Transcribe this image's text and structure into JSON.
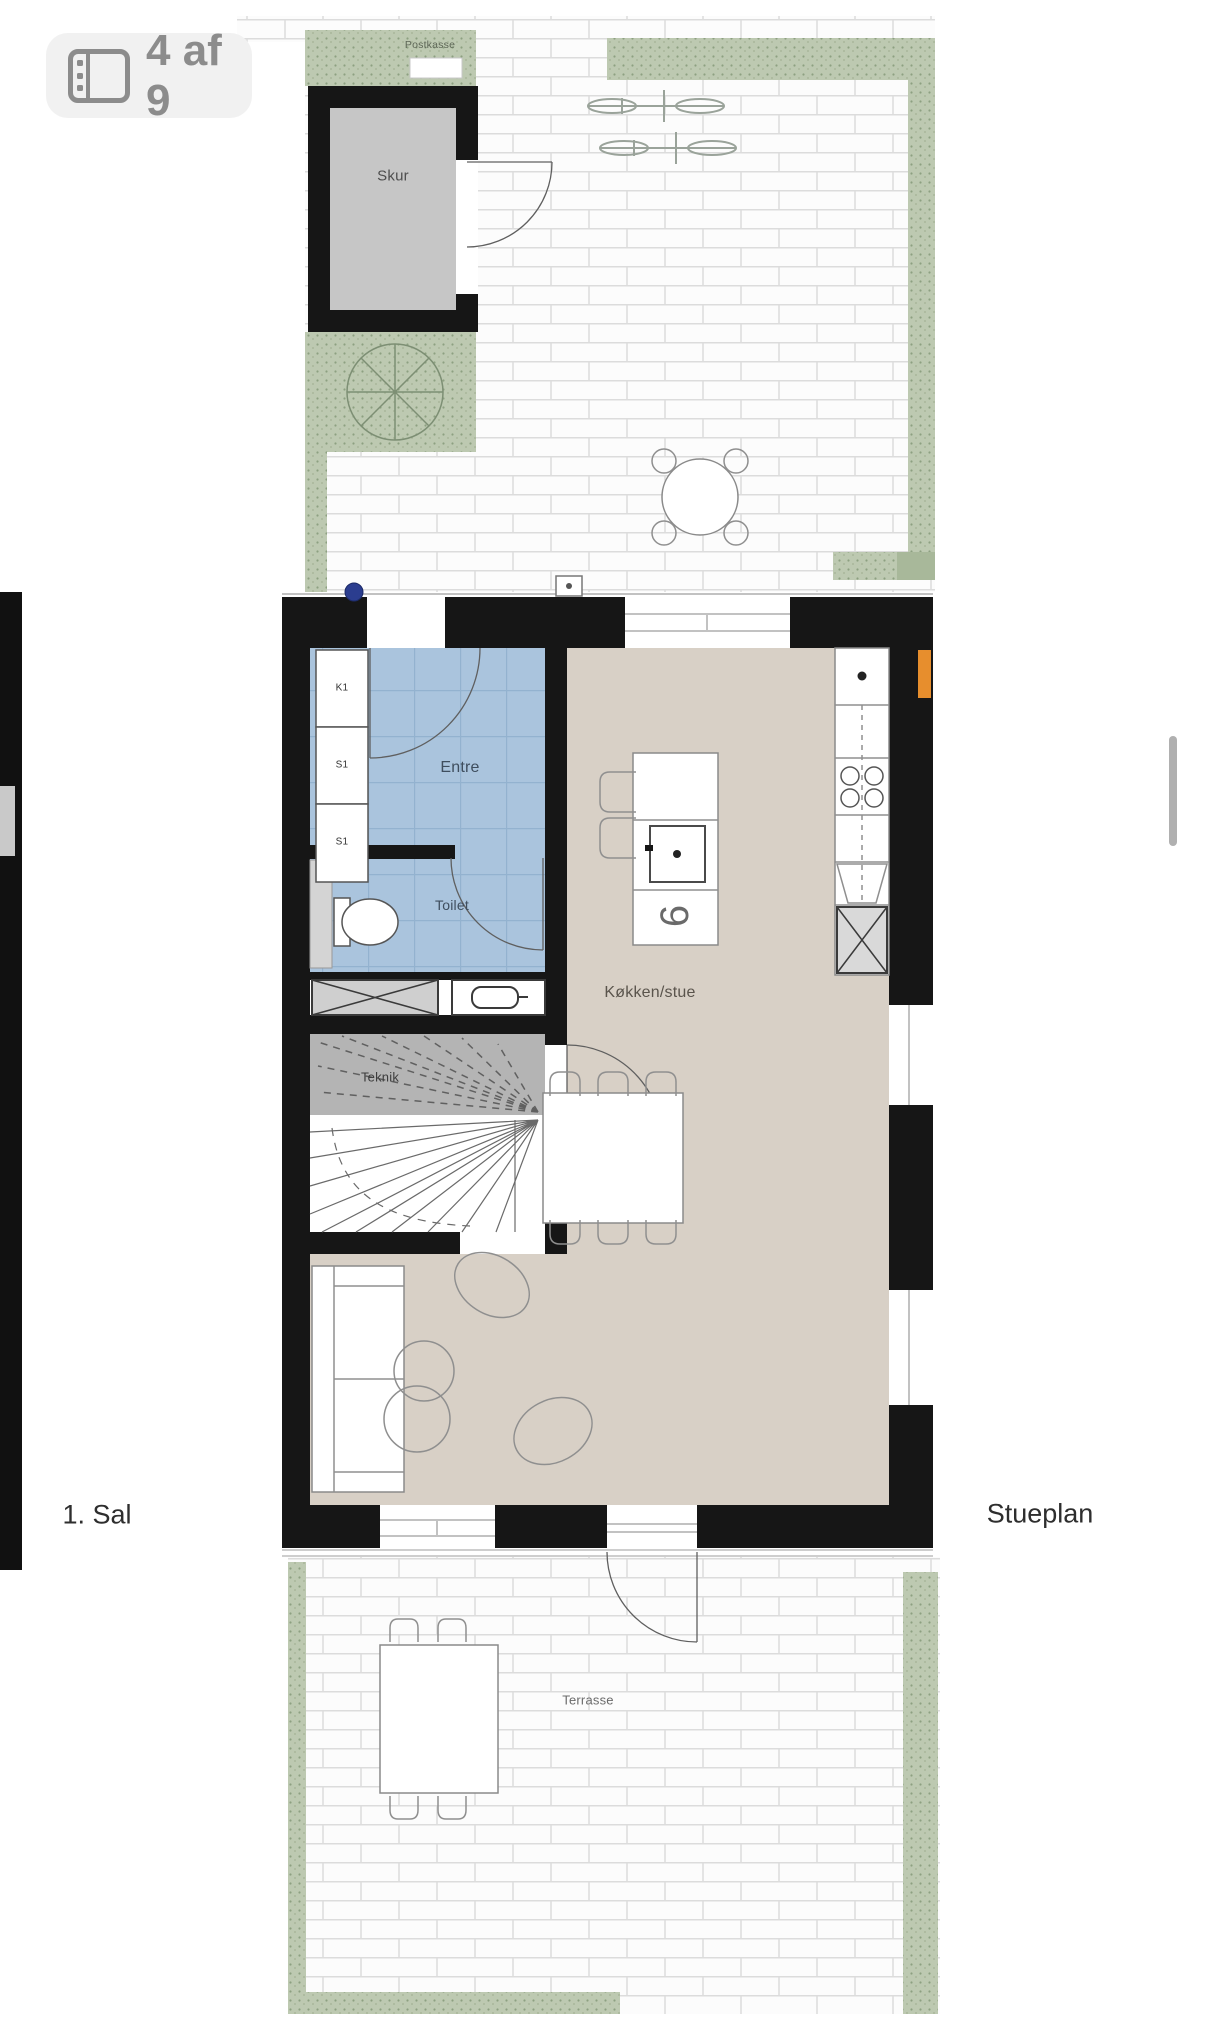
{
  "badge": {
    "label": "4 af 9",
    "icon": "floorplan-icon"
  },
  "labels": {
    "floor_left": "1. Sal",
    "floor_right": "Stueplan"
  },
  "rooms": {
    "postkasse": "Postkasse",
    "skur": "Skur",
    "entre": "Entre",
    "toilet": "Toilet",
    "teknik": "Teknik",
    "kitchen": "Køkken/stue",
    "terrace": "Terrasse"
  },
  "closets": [
    "K1",
    "S1",
    "S1"
  ],
  "colors": {
    "wall": "#161616",
    "living_floor": "#d8d0c6",
    "entre_floor": "#aac4dd",
    "hedge": "#bdc9b1",
    "teknik_floor": "#b4b4b4",
    "shed_floor": "#c6c6c6",
    "orange_marker": "#e78e2d",
    "blue_dot": "#2b3d8f",
    "badge_bg": "#f1f1f1",
    "badge_fg": "#8c8c8c"
  }
}
